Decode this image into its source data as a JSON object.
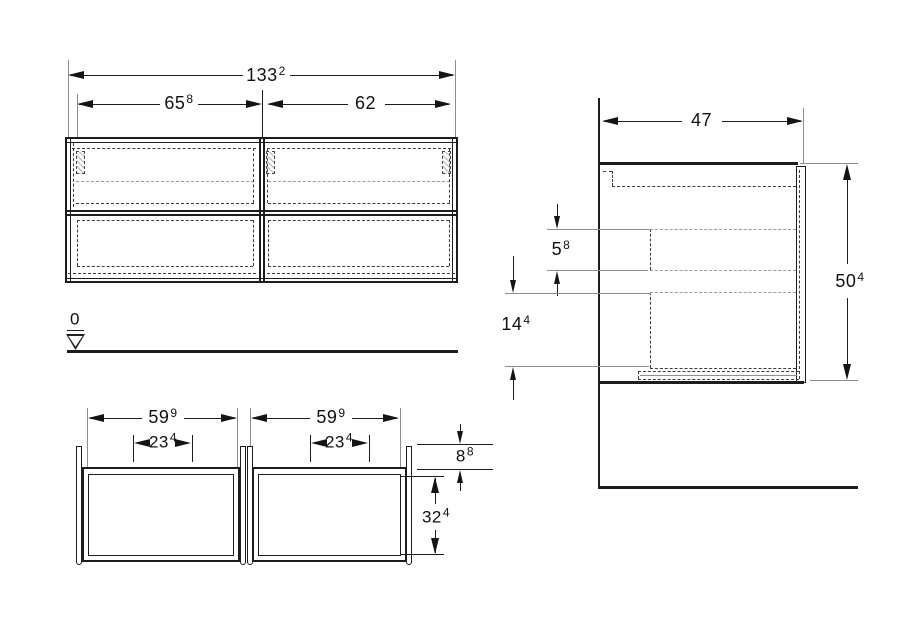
{
  "drawing": {
    "type": "furniture-dimension-drawing",
    "units_note": "",
    "colors": {
      "line": "#1d1d1d",
      "extension_line": "#8e8e8e",
      "dashed_line": "#3c3c3c",
      "background": "#ffffff",
      "text": "#111111"
    },
    "datum": {
      "label": "0"
    },
    "front_view": {
      "total_width": {
        "value": "133",
        "sup": "2"
      },
      "left_width": {
        "value": "65",
        "sup": "8"
      },
      "right_width": {
        "value": "62",
        "sup": ""
      }
    },
    "plan_view": {
      "left_width": {
        "value": "59",
        "sup": "9"
      },
      "right_width": {
        "value": "59",
        "sup": "9"
      },
      "left_cutout": {
        "value": "23",
        "sup": "4"
      },
      "right_cutout": {
        "value": "23",
        "sup": "4"
      },
      "back_offset": {
        "value": "8",
        "sup": "8"
      },
      "inner_depth": {
        "value": "32",
        "sup": "4"
      }
    },
    "side_view": {
      "depth": {
        "value": "47",
        "sup": ""
      },
      "gap_height": {
        "value": "5",
        "sup": "8"
      },
      "drawer_height": {
        "value": "14",
        "sup": "4"
      },
      "total_height": {
        "value": "50",
        "sup": "4"
      }
    }
  }
}
